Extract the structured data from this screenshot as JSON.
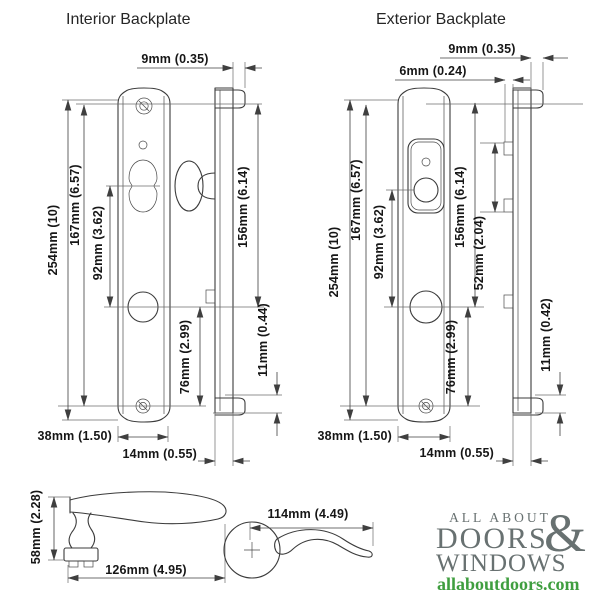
{
  "titles": {
    "interior": "Interior Backplate",
    "exterior": "Exterior Backplate"
  },
  "interior": {
    "dims": {
      "d9": "9mm (0.35)",
      "d254": "254mm (10)",
      "d167": "167mm (6.57)",
      "d92": "92mm (3.62)",
      "d156": "156mm (6.14)",
      "d76": "76mm (2.99)",
      "d11": "11mm (0.44)",
      "d38": "38mm (1.50)",
      "d14": "14mm (0.55)"
    }
  },
  "exterior": {
    "dims": {
      "d9": "9mm (0.35)",
      "d6": "6mm (0.24)",
      "d254": "254mm (10)",
      "d167": "167mm (6.57)",
      "d92": "92mm (3.62)",
      "d156": "156mm (6.14)",
      "d52": "52mm (2.04)",
      "d76": "76mm (2.99)",
      "d11": "11mm (0.42)",
      "d38": "38mm (1.50)",
      "d14": "14mm (0.55)"
    }
  },
  "handle": {
    "d58": "58mm (2.28)",
    "d126": "126mm (4.95)",
    "d114": "114mm (4.49)"
  },
  "logo": {
    "line1": "ALL ABOUT",
    "amp": "&",
    "line2": "DOORS",
    "line3": "WINDOWS",
    "url": "allaboutdoors.com",
    "text_color": "#687171",
    "url_color": "#3f9e3f"
  }
}
